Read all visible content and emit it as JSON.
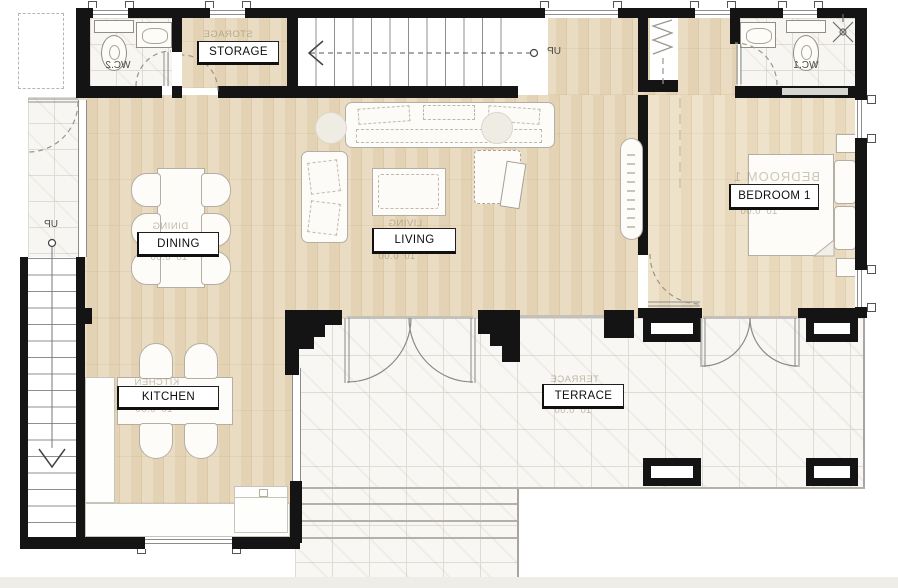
{
  "meta": {
    "type": "architectural-floor-plan",
    "floor": "ground floor"
  },
  "palette": {
    "wall": "#141414",
    "wood_floor": "#e5d5b6",
    "marble_floor": "#f7f6f3",
    "label_border": "#1f1f1f",
    "ghost_text": "#94846a"
  },
  "rooms": {
    "storage": {
      "label": "STORAGE"
    },
    "dining": {
      "label": "DINING"
    },
    "living": {
      "label": "LIVING"
    },
    "kitchen": {
      "label": "KITCHEN"
    },
    "terrace": {
      "label": "TERRACE"
    },
    "bedroom1": {
      "label": "BEDROOM 1"
    },
    "wc1": {
      "label": "WC.1"
    },
    "wc2": {
      "label": "WC.2"
    }
  },
  "stairs": {
    "top_stair_label": "UP",
    "left_stair_label": "UP"
  },
  "ghost": {
    "dim": "10' 0.00"
  }
}
